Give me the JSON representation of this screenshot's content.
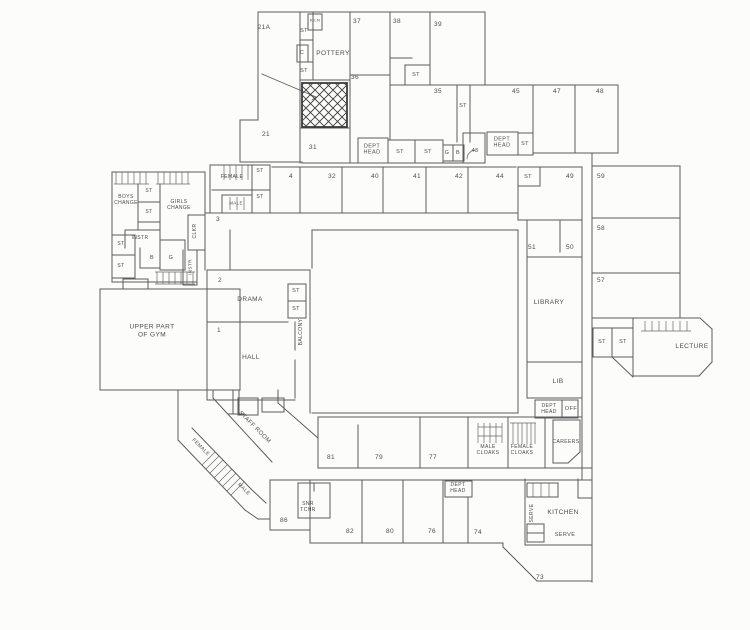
{
  "colors": {
    "ink": "#4f4f4f",
    "paper": "#fcfcfb",
    "hatch": "#3c3c3c"
  },
  "labels": [
    {
      "id": "room-21a",
      "text": "21A",
      "x": 264,
      "y": 28
    },
    {
      "id": "st-pottery-top",
      "text": "ST",
      "x": 304,
      "y": 31,
      "size": 5.5
    },
    {
      "id": "kiln",
      "text": "KILN",
      "x": 315,
      "y": 21,
      "size": 4
    },
    {
      "id": "c-store",
      "text": "C",
      "x": 302,
      "y": 53,
      "size": 5.5
    },
    {
      "id": "pottery",
      "text": "POTTERY",
      "x": 333,
      "y": 54
    },
    {
      "id": "st-pottery-low",
      "text": "ST",
      "x": 304,
      "y": 71,
      "size": 5.5
    },
    {
      "id": "room-37",
      "text": "37",
      "x": 357,
      "y": 22
    },
    {
      "id": "room-38",
      "text": "38",
      "x": 397,
      "y": 22
    },
    {
      "id": "room-39",
      "text": "39",
      "x": 438,
      "y": 25
    },
    {
      "id": "room-36",
      "text": "36",
      "x": 355,
      "y": 78
    },
    {
      "id": "st-38",
      "text": "ST",
      "x": 416,
      "y": 75,
      "size": 5.5
    },
    {
      "id": "room-35",
      "text": "35",
      "x": 438,
      "y": 92
    },
    {
      "id": "st-corr-top",
      "text": "ST",
      "x": 463,
      "y": 106,
      "size": 5.5
    },
    {
      "id": "room-21",
      "text": "21",
      "x": 266,
      "y": 135
    },
    {
      "id": "room-31",
      "text": "31",
      "x": 313,
      "y": 148
    },
    {
      "id": "dept-head-top",
      "text": "DEPT\nHEAD",
      "x": 372,
      "y": 150,
      "size": 5.5
    },
    {
      "id": "st-corr1",
      "text": "ST",
      "x": 400,
      "y": 152,
      "size": 5.5
    },
    {
      "id": "st-corr2",
      "text": "ST",
      "x": 428,
      "y": 152,
      "size": 5.5
    },
    {
      "id": "g-top",
      "text": "G",
      "x": 447,
      "y": 153,
      "size": 5.5
    },
    {
      "id": "b-top",
      "text": "B",
      "x": 458,
      "y": 153,
      "size": 5.5
    },
    {
      "id": "room-43",
      "text": "43",
      "x": 475,
      "y": 151,
      "size": 5.5
    },
    {
      "id": "room-45",
      "text": "45",
      "x": 516,
      "y": 92
    },
    {
      "id": "room-47",
      "text": "47",
      "x": 557,
      "y": 92
    },
    {
      "id": "room-48",
      "text": "48",
      "x": 600,
      "y": 92
    },
    {
      "id": "dept-head-wing",
      "text": "DEPT\nHEAD",
      "x": 502,
      "y": 143,
      "size": 5.5
    },
    {
      "id": "st-wing",
      "text": "ST",
      "x": 525,
      "y": 144,
      "size": 5.5
    },
    {
      "id": "female-wc",
      "text": "FEMALE",
      "x": 232,
      "y": 178,
      "size": 5
    },
    {
      "id": "st-wc1",
      "text": "ST",
      "x": 260,
      "y": 172,
      "size": 5
    },
    {
      "id": "male-wc",
      "text": "MALE",
      "x": 236,
      "y": 203,
      "size": 4.5
    },
    {
      "id": "st-wc2",
      "text": "ST",
      "x": 260,
      "y": 198,
      "size": 5
    },
    {
      "id": "room-3",
      "text": "3",
      "x": 218,
      "y": 220
    },
    {
      "id": "room-4",
      "text": "4",
      "x": 291,
      "y": 177
    },
    {
      "id": "room-32",
      "text": "32",
      "x": 332,
      "y": 177
    },
    {
      "id": "room-40",
      "text": "40",
      "x": 375,
      "y": 177
    },
    {
      "id": "room-41",
      "text": "41",
      "x": 417,
      "y": 177
    },
    {
      "id": "room-42",
      "text": "42",
      "x": 459,
      "y": 177
    },
    {
      "id": "room-44",
      "text": "44",
      "x": 500,
      "y": 177
    },
    {
      "id": "st-mid",
      "text": "ST",
      "x": 528,
      "y": 177,
      "size": 5.5
    },
    {
      "id": "room-49",
      "text": "49",
      "x": 570,
      "y": 177
    },
    {
      "id": "room-59",
      "text": "59",
      "x": 601,
      "y": 177
    },
    {
      "id": "room-58",
      "text": "58",
      "x": 601,
      "y": 229
    },
    {
      "id": "room-57",
      "text": "57",
      "x": 601,
      "y": 281
    },
    {
      "id": "room-51",
      "text": "51",
      "x": 532,
      "y": 248
    },
    {
      "id": "room-50",
      "text": "50",
      "x": 570,
      "y": 248
    },
    {
      "id": "library",
      "text": "LIBRARY",
      "x": 549,
      "y": 303
    },
    {
      "id": "boys-change",
      "text": "BOYS\nCHANGE",
      "x": 126,
      "y": 201,
      "size": 5
    },
    {
      "id": "st-west1",
      "text": "ST",
      "x": 149,
      "y": 192,
      "size": 5
    },
    {
      "id": "girls-change",
      "text": "GIRLS\nCHANGE",
      "x": 179,
      "y": 206,
      "size": 5
    },
    {
      "id": "st-west2",
      "text": "ST",
      "x": 149,
      "y": 213,
      "size": 5
    },
    {
      "id": "instr-west",
      "text": "INSTR",
      "x": 140,
      "y": 239,
      "size": 5
    },
    {
      "id": "clkr",
      "text": "CLKR",
      "x": 196,
      "y": 231,
      "rot": -90,
      "size": 5
    },
    {
      "id": "st-west3",
      "text": "ST",
      "x": 121,
      "y": 245,
      "size": 5
    },
    {
      "id": "b-west",
      "text": "B",
      "x": 152,
      "y": 258,
      "size": 5.5
    },
    {
      "id": "g-west",
      "text": "G",
      "x": 171,
      "y": 258,
      "size": 5.5
    },
    {
      "id": "instr-west-v",
      "text": "INSTR",
      "x": 190,
      "y": 267,
      "rot": -90,
      "size": 4.5
    },
    {
      "id": "st-west4",
      "text": "ST",
      "x": 121,
      "y": 267,
      "size": 5
    },
    {
      "id": "gym",
      "text": "UPPER PART\nOF GYM",
      "x": 152,
      "y": 331
    },
    {
      "id": "room-2",
      "text": "2",
      "x": 220,
      "y": 281
    },
    {
      "id": "drama",
      "text": "DRAMA",
      "x": 250,
      "y": 300
    },
    {
      "id": "st-drama1",
      "text": "ST",
      "x": 296,
      "y": 291,
      "size": 5.5
    },
    {
      "id": "st-drama2",
      "text": "ST",
      "x": 296,
      "y": 309,
      "size": 5.5
    },
    {
      "id": "balcony",
      "text": "BALCONY",
      "x": 302,
      "y": 332,
      "rot": -90,
      "size": 5
    },
    {
      "id": "room-1",
      "text": "1",
      "x": 219,
      "y": 331
    },
    {
      "id": "hall",
      "text": "HALL",
      "x": 251,
      "y": 358
    },
    {
      "id": "staff-room",
      "text": "STAFF ROOM",
      "x": 254,
      "y": 428,
      "rot": 45,
      "size": 6
    },
    {
      "id": "female-stairs",
      "text": "FEMALE",
      "x": 200,
      "y": 448,
      "rot": 45,
      "size": 5
    },
    {
      "id": "male-stairs",
      "text": "MALE",
      "x": 243,
      "y": 490,
      "rot": 45,
      "size": 5
    },
    {
      "id": "room-81",
      "text": "81",
      "x": 331,
      "y": 458
    },
    {
      "id": "room-79",
      "text": "79",
      "x": 379,
      "y": 458
    },
    {
      "id": "room-77",
      "text": "77",
      "x": 433,
      "y": 458
    },
    {
      "id": "male-cloaks",
      "text": "MALE\nCLOAKS",
      "x": 488,
      "y": 451,
      "size": 5
    },
    {
      "id": "female-cloaks",
      "text": "FEMALE\nCLOAKS",
      "x": 522,
      "y": 451,
      "size": 5
    },
    {
      "id": "careers",
      "text": "CAREERS",
      "x": 566,
      "y": 443,
      "size": 5
    },
    {
      "id": "lib",
      "text": "LIB",
      "x": 558,
      "y": 382
    },
    {
      "id": "dept-head-lib",
      "text": "DEPT\nHEAD",
      "x": 549,
      "y": 410,
      "size": 5
    },
    {
      "id": "off",
      "text": "OFF",
      "x": 571,
      "y": 409,
      "size": 5.5
    },
    {
      "id": "room-86",
      "text": "86",
      "x": 284,
      "y": 521
    },
    {
      "id": "snr-tchr",
      "text": "SNR\nTCHR",
      "x": 308,
      "y": 508,
      "size": 5
    },
    {
      "id": "room-82",
      "text": "82",
      "x": 350,
      "y": 532
    },
    {
      "id": "room-80",
      "text": "80",
      "x": 390,
      "y": 532
    },
    {
      "id": "room-76",
      "text": "76",
      "x": 432,
      "y": 532
    },
    {
      "id": "dept-head-bot",
      "text": "DEPT\nHEAD",
      "x": 458,
      "y": 489,
      "size": 5
    },
    {
      "id": "room-74",
      "text": "74",
      "x": 478,
      "y": 533
    },
    {
      "id": "serve-vert",
      "text": "SERVE",
      "x": 533,
      "y": 513,
      "rot": -90,
      "size": 5
    },
    {
      "id": "kitchen",
      "text": "KITCHEN",
      "x": 563,
      "y": 513
    },
    {
      "id": "serve-horiz",
      "text": "SERVE",
      "x": 565,
      "y": 535,
      "size": 5.5
    },
    {
      "id": "room-73",
      "text": "73",
      "x": 540,
      "y": 578
    },
    {
      "id": "st-lect1",
      "text": "ST",
      "x": 602,
      "y": 342,
      "size": 5.5
    },
    {
      "id": "st-lect2",
      "text": "ST",
      "x": 623,
      "y": 342,
      "size": 5.5
    },
    {
      "id": "lecture",
      "text": "LECTURE",
      "x": 692,
      "y": 347
    }
  ]
}
